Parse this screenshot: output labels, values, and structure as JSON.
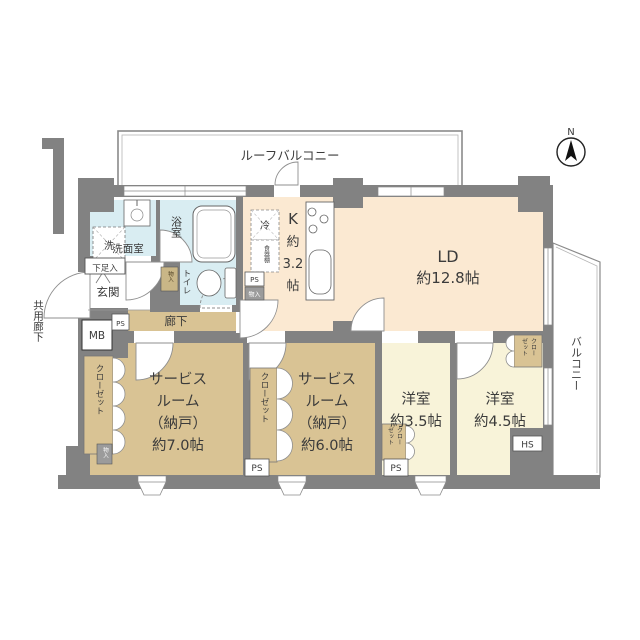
{
  "compass": {
    "north": "N"
  },
  "outdoor": {
    "roof_balcony": "ルーフバルコニー",
    "balcony": "バルコニー",
    "shared_corridor": "共用廊下"
  },
  "rooms": {
    "ld": {
      "name": "LD",
      "size": "約12.8帖"
    },
    "kitchen": {
      "chars": [
        "K",
        "約",
        "3.2",
        "帖"
      ]
    },
    "service7": {
      "lines": [
        "サービス",
        "ルーム",
        "（納戸）",
        "約7.0帖"
      ]
    },
    "service6": {
      "lines": [
        "サービス",
        "ルーム",
        "（納戸）",
        "約6.0帖"
      ]
    },
    "western35": {
      "lines": [
        "洋室",
        "約3.5帖"
      ]
    },
    "western45": {
      "lines": [
        "洋室",
        "約4.5帖"
      ]
    },
    "bath": "浴室",
    "washroom": "洗面室",
    "toilet": "トイレ",
    "entrance": "玄関",
    "hallway": "廊下"
  },
  "storage": {
    "closet": "クローゼット",
    "closet_col1": "クロー",
    "closet_col2": "ゼット",
    "shoe_box": "下足入",
    "storage_small": "物入"
  },
  "labels": {
    "mb": "MB",
    "ps": "PS",
    "hs": "HS",
    "fridge": "冷",
    "cupboard": "食器棚",
    "washer": "洗"
  },
  "colors": {
    "wall": "#828282",
    "ld_floor": "#fbe9d2",
    "tatami_tan": "#d9c394",
    "western_floor": "#f8f3d9",
    "wet_area": "#d9edf2"
  }
}
